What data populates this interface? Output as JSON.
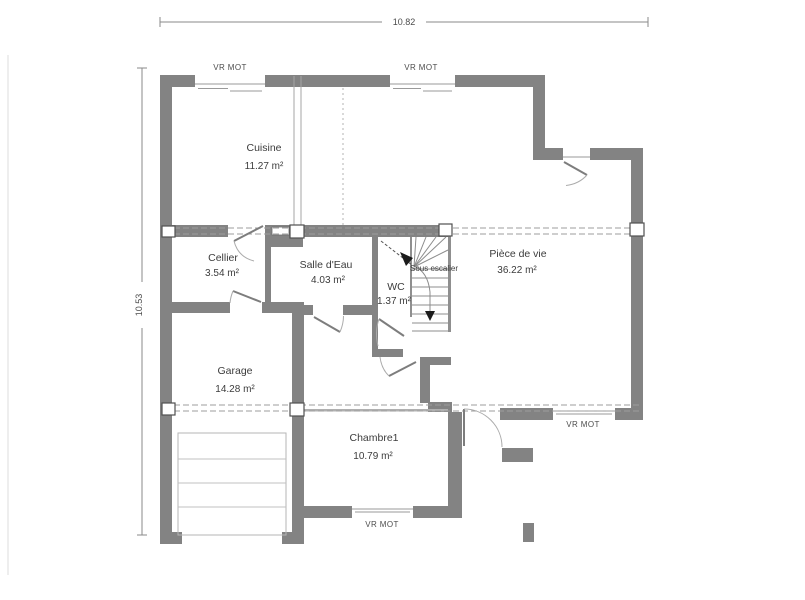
{
  "dimensions": {
    "horizontal": "10.82",
    "vertical": "10.53"
  },
  "window_labels": {
    "top_left": "VR MOT",
    "top_center": "VR MOT",
    "right_bottom": "VR MOT",
    "bottom_center": "VR MOT"
  },
  "rooms": {
    "cuisine": {
      "name": "Cuisine",
      "area": "11.27 m²"
    },
    "cellier": {
      "name": "Cellier",
      "area": "3.54 m²"
    },
    "salle_deau": {
      "name": "Salle d'Eau",
      "area": "4.03 m²"
    },
    "wc": {
      "name": "WC",
      "area": "1.37 m²"
    },
    "piece_de_vie": {
      "name": "Pièce de vie",
      "area": "36.22 m²"
    },
    "garage": {
      "name": "Garage",
      "area": "14.28 m²"
    },
    "chambre1": {
      "name": "Chambre1",
      "area": "10.79 m²"
    }
  },
  "stairs": {
    "label": "Sous escalier"
  },
  "colors": {
    "wall": "#838383",
    "line": "#9a9a9a",
    "text": "#3c3c3c",
    "accent_black": "#1c1c1c"
  }
}
